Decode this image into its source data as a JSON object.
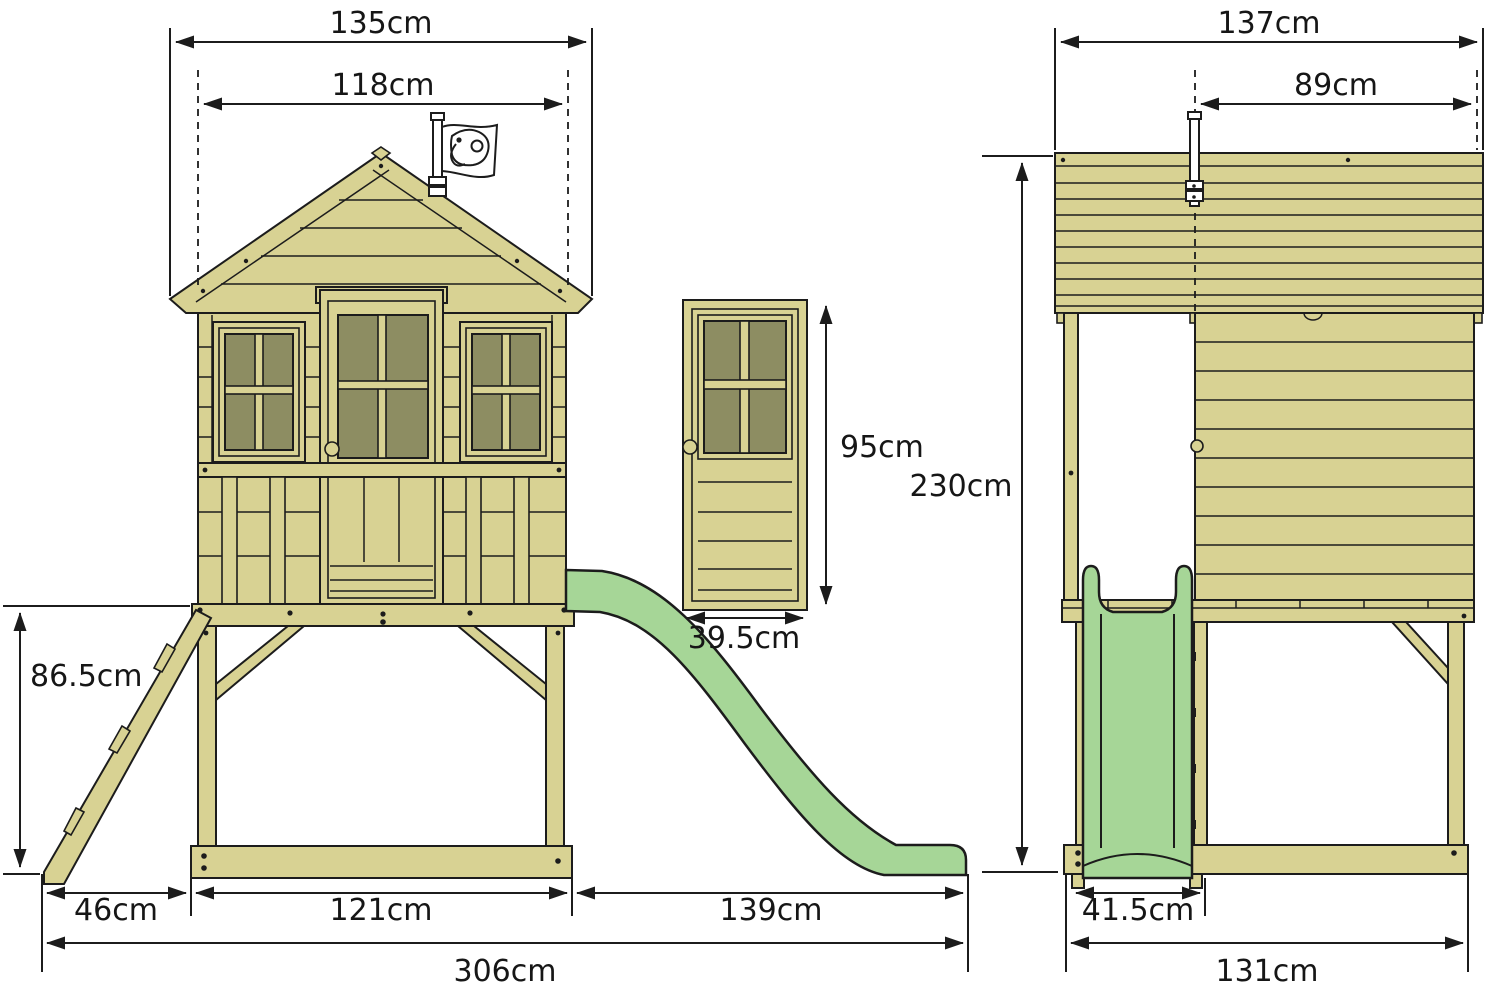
{
  "diagram": {
    "type": "product-dimension-drawing",
    "subject": "wooden stilted playhouse with slide, ladder and flag",
    "unit": "cm",
    "views": {
      "front": "front elevation with ladder and slide",
      "door_detail": "door detail",
      "side": "side elevation with slide seen head-on"
    },
    "colors": {
      "wood": "#d8d293",
      "window_glass": "#8d8d62",
      "slide_green": "#a6d697",
      "outline": "#1c1c1c",
      "background": "#ffffff"
    }
  },
  "dims": {
    "front_roof_width": "135cm",
    "front_body_width": "118cm",
    "front_platform_height": "86.5cm",
    "front_ladder_footprint": "46cm",
    "front_base_length": "121cm",
    "front_slide_run": "139cm",
    "front_total_length": "306cm",
    "door_height": "95cm",
    "door_width": "39.5cm",
    "side_roof_depth": "137cm",
    "side_body_depth": "89cm",
    "side_total_height": "230cm",
    "side_slide_width": "41.5cm",
    "side_base_depth": "131cm"
  }
}
